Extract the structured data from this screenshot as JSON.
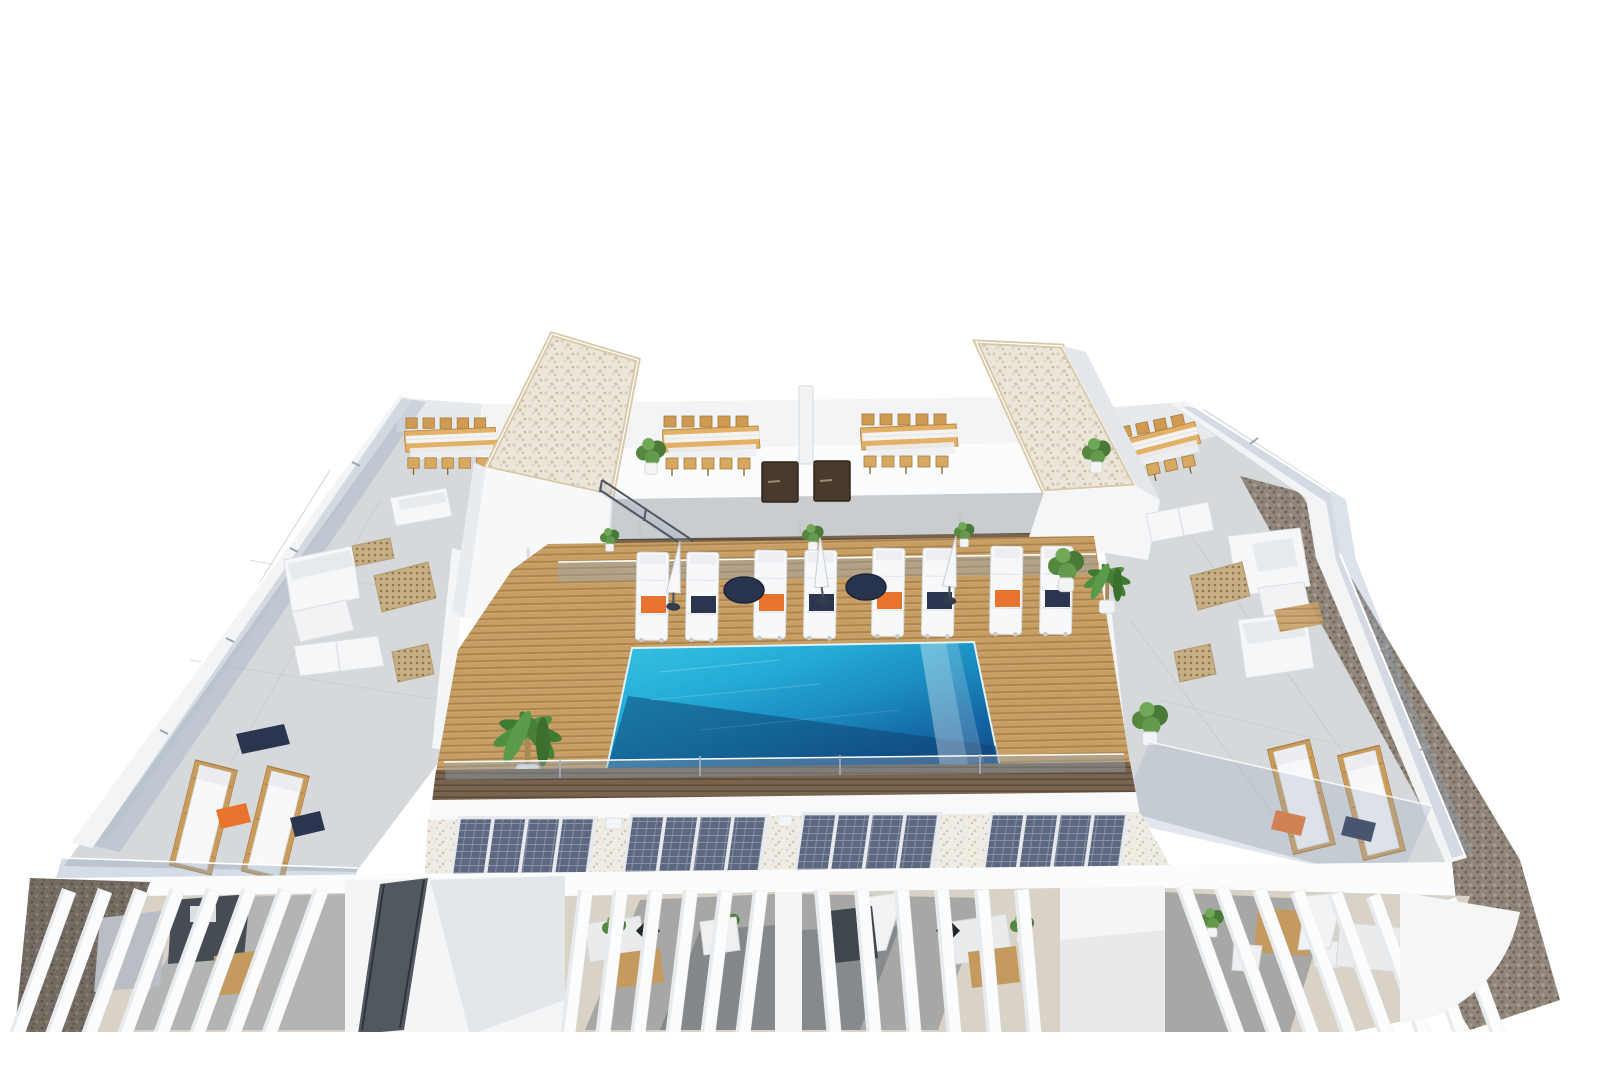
{
  "scene": {
    "type": "3d-architectural-render",
    "description": "Aerial 3D architectural rendering of a residential rooftop solarium: central swimming pool on a wooden deck surrounded by white sun loungers with orange and navy towels, closed parasols, two stairwell towers with white gravel roofs, communal timber dining tables, concrete side terraces with white lounge sofas and ventilation grates, glass balustrades, four solar panel arrays on a pebble roof strip, pergola-covered private terraces along the bottom edge and brown gravel along the outer right edge.",
    "background_color": "#ffffff",
    "canvas": {
      "width": 1600,
      "height": 1067
    }
  },
  "palette": {
    "pool_water_light": "#3ac4e2",
    "pool_water_mid": "#1b8cc0",
    "pool_water_dark": "#0f4a84",
    "deck_wood": "#c79e63",
    "deck_wood_gap": "#a9834f",
    "walkway_wood_dark": "#77634e",
    "concrete_terrace": "#d6d9db",
    "white_structure": "#f7f8f9",
    "tower_gravel_roof": "#ece6da",
    "tower_roof_trim": "#d8c9a8",
    "pebble_roof": "#f0ece3",
    "perimeter_gravel": "#8f857a",
    "solar_panel": "#5d6880",
    "solar_frame": "#e8eaed",
    "glass_railing": "rgba(148,168,190,0.38)",
    "towel_orange": "#e8732c",
    "towel_navy": "#2b3550",
    "side_table_navy": "#28334d",
    "furniture_wood": "#d7a85f",
    "plant_green": "#4f8140",
    "stone_tile": "#d9d3c7",
    "shadow_slate": "#596066"
  },
  "inventory": {
    "swimming_pool": {
      "count": 1,
      "shape": "rectangular",
      "feature": "infinity edge with white cascade on right side"
    },
    "deck_sun_loungers": {
      "count": 8,
      "cushion_color": "white",
      "towel_colors": [
        "orange",
        "navy",
        "orange",
        "navy",
        "orange",
        "navy",
        "orange",
        "navy"
      ]
    },
    "closed_parasols_on_deck": {
      "count": 3,
      "color": "white"
    },
    "round_side_tables": {
      "count": 2,
      "color": "navy"
    },
    "stairwell_towers": {
      "count": 2,
      "roof": "white gravel with timber trim"
    },
    "communal_dining_tables": {
      "count": 4,
      "seats_each": 10,
      "material": "light wood"
    },
    "solar_panel_arrays": {
      "count": 4,
      "panels_per_array": 4
    },
    "side_terrace_wood_loungers": {
      "count": 4,
      "towel_colors": [
        "orange",
        "navy",
        "orange",
        "navy"
      ]
    },
    "white_lounge_sofas": {
      "count": 5
    },
    "white_daybed_mattresses": {
      "count": 2
    },
    "ventilation_grates": {
      "count": 5
    },
    "access_doors": {
      "count": 2,
      "color": "dark brown"
    },
    "pergola_sections": {
      "count": 4
    },
    "potted_plants": {
      "count": 12
    }
  }
}
